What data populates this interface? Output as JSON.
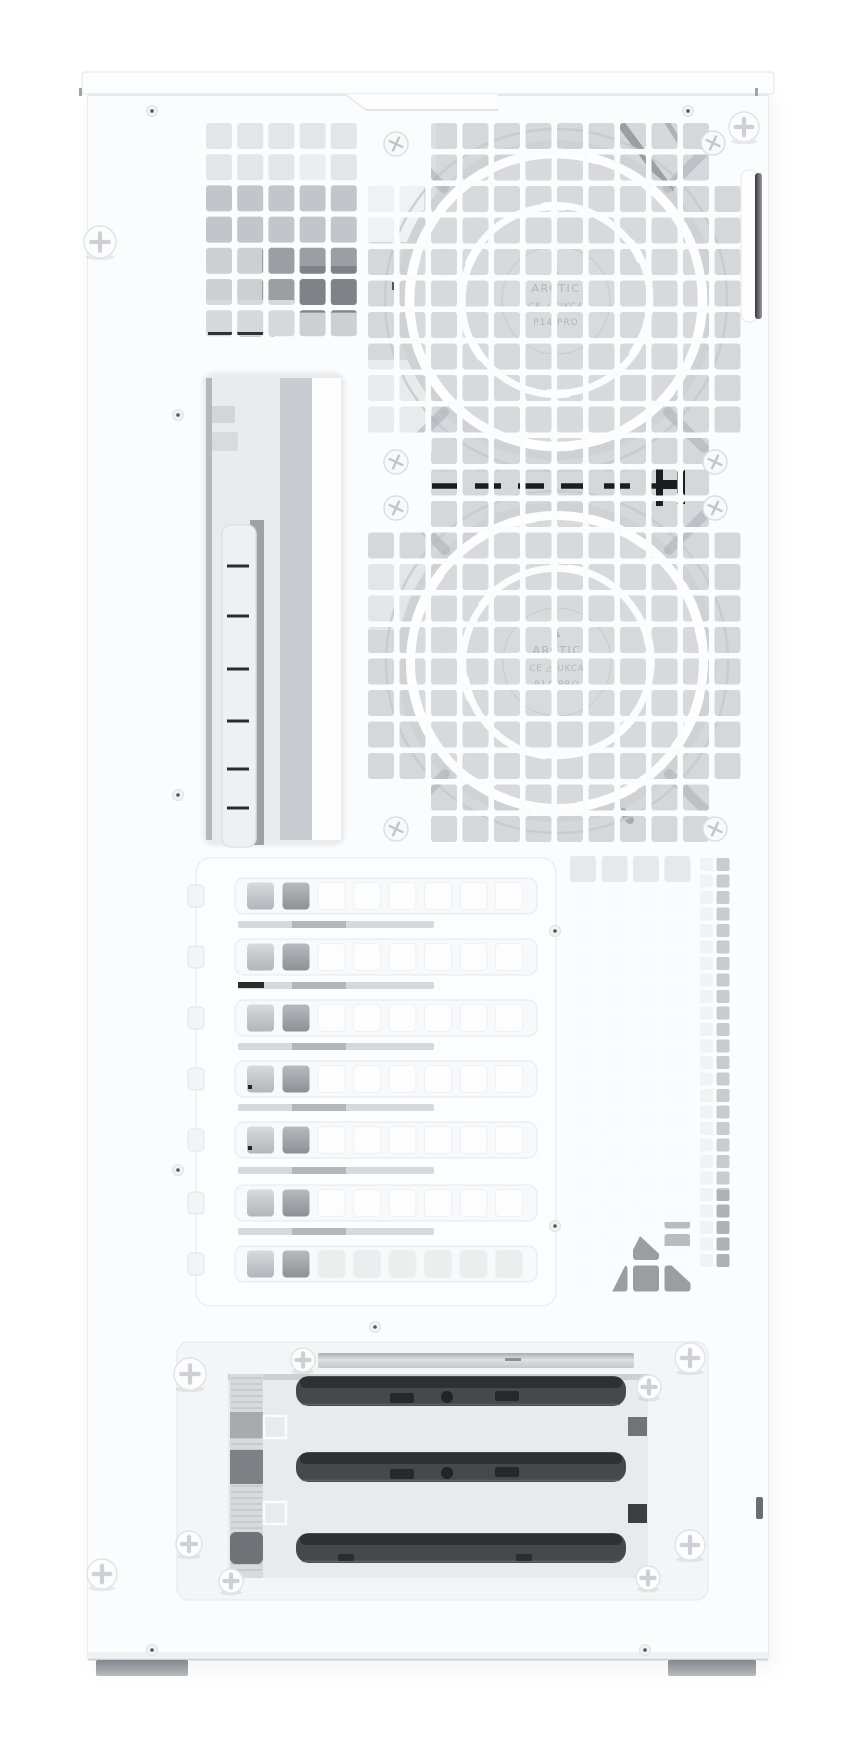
{
  "meta": {
    "description": "Product photograph of a white ATX PC tower case seen from the rear-left side, showing a perforated square-hole mesh side panel, two white ARCTIC P14 PRO fans mounted behind the mesh, a vertical bracket cutout, seven ventilated PCI expansion slot covers, a lower mesh section and a bottom access panel with three dark drive trays secured by white thumbscrews."
  },
  "labels": {
    "fan_logo_mark": "▲",
    "fan_brand": "ARCTIC",
    "fan_cert": "CE △ UKCA",
    "fan_model": "P14 PRO"
  },
  "colors": {
    "bg": "#ffffff",
    "panel": "#fbfcfd",
    "panel_edge": "#e2e5e8",
    "interior": "#d5d7da",
    "interior_light": "#e9ebed",
    "fan_ring": "#c6c9cd",
    "fan_hub": "#d8dadc",
    "blade": "#ffffff",
    "cable": "#1c1d1f",
    "drive": "#46484c",
    "drive_dark": "#2e3033",
    "recess": "#f4f5f7",
    "window": "#e9eaec",
    "foot_dark": "#969aa0",
    "hub_text": "#b2b5b9"
  },
  "geometry": {
    "canvas": {
      "w": 857,
      "h": 1754
    },
    "case": {
      "x": 88,
      "y": 93,
      "w": 680,
      "h": 1567
    },
    "mesh_zones": [
      {
        "name": "upper-left-grid",
        "x": 206,
        "y": 123,
        "cols": 5,
        "rows": 7,
        "pitch": 31.2,
        "size": 26,
        "rx": 3,
        "exclude": []
      },
      {
        "name": "fan-grid",
        "x": 368,
        "y": 123,
        "cols": 12,
        "rows": 23,
        "pitch": 31.5,
        "size": 26,
        "rx": 3,
        "exclude": [
          [
            0,
            0
          ],
          [
            1,
            0
          ],
          [
            0,
            1
          ],
          [
            1,
            1
          ],
          [
            11,
            0
          ],
          [
            11,
            1
          ],
          [
            0,
            10
          ],
          [
            1,
            10
          ],
          [
            0,
            11
          ],
          [
            1,
            11
          ],
          [
            0,
            12
          ],
          [
            1,
            12
          ],
          [
            11,
            10
          ],
          [
            11,
            11
          ],
          [
            11,
            12
          ],
          [
            0,
            21
          ],
          [
            1,
            21
          ],
          [
            0,
            22
          ],
          [
            1,
            22
          ],
          [
            11,
            21
          ],
          [
            11,
            22
          ]
        ]
      },
      {
        "name": "lower-right-grid",
        "x": 570,
        "y": 856,
        "cols": 4,
        "rows": 14,
        "pitch": 31.5,
        "size": 26,
        "rx": 3,
        "exclude": []
      },
      {
        "name": "edge-strip-grid",
        "x": 700,
        "y": 858,
        "cols": 2,
        "rows": 25,
        "pitch": 16.5,
        "size": 13,
        "rx": 2,
        "exclude": []
      }
    ],
    "fans": [
      {
        "cx": 556,
        "cy": 300,
        "r": 170,
        "show_brand": true
      },
      {
        "cx": 557,
        "cy": 662,
        "r": 170,
        "show_brand": true
      }
    ],
    "cable": {
      "y": 486,
      "x1": 432,
      "x2": 656
    },
    "pci": {
      "frame": {
        "x": 196,
        "y": 858,
        "w": 360,
        "h": 448,
        "rx": 14
      },
      "covers": {
        "x": 235,
        "w": 302,
        "h": 36,
        "rx": 9,
        "ys": [
          878,
          939,
          1000,
          1061,
          1122,
          1185,
          1246
        ],
        "holes": {
          "x0": 247,
          "pitch": 35.5,
          "size": 27,
          "count": 8,
          "rx": 4
        }
      },
      "gaps": {
        "x": 238,
        "w": 196,
        "h": 7,
        "ys": [
          921,
          982,
          1043,
          1104,
          1167,
          1228
        ]
      },
      "tabs": {
        "x": 188,
        "w": 16,
        "h": 22,
        "rx": 4
      }
    },
    "ladder": {
      "x": 224,
      "w": 32,
      "top": 527,
      "bottom": 845,
      "rungs": [
        566,
        616,
        669,
        721,
        769,
        808
      ]
    },
    "drives": {
      "x": 296,
      "w": 330,
      "h": 30,
      "rx": 13,
      "ys": [
        1376,
        1452,
        1533
      ]
    },
    "screws": {
      "thumb": [
        [
          100,
          242,
          16
        ],
        [
          744,
          127,
          15
        ],
        [
          190,
          1374,
          16
        ],
        [
          303,
          1360,
          12
        ],
        [
          690,
          1358,
          15
        ],
        [
          649,
          1387,
          12
        ],
        [
          690,
          1545,
          15
        ],
        [
          648,
          1578,
          12
        ],
        [
          102,
          1574,
          15
        ],
        [
          189,
          1544,
          13
        ],
        [
          231,
          1581,
          12
        ]
      ],
      "flush": [
        [
          396,
          144
        ],
        [
          713,
          143
        ],
        [
          396,
          462
        ],
        [
          715,
          462
        ],
        [
          396,
          508
        ],
        [
          715,
          508
        ],
        [
          396,
          829
        ],
        [
          715,
          829
        ]
      ],
      "pin": [
        [
          152,
          111
        ],
        [
          688,
          111
        ],
        [
          178,
          415
        ],
        [
          178,
          795
        ],
        [
          178,
          1170
        ],
        [
          555,
          931
        ],
        [
          555,
          1226
        ],
        [
          375,
          1327
        ],
        [
          152,
          1650
        ],
        [
          645,
          1650
        ]
      ]
    }
  }
}
